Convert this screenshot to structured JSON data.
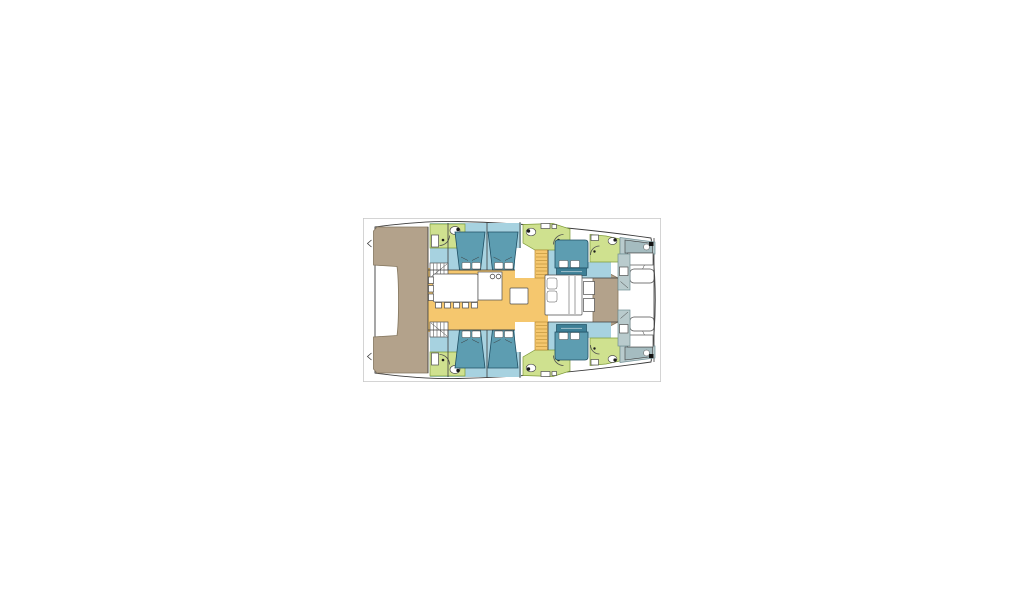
{
  "scene": {
    "type": "yacht-deck-plan",
    "vessel": "sailing-catamaran",
    "view": "top-down-interior-layout",
    "orientation": "bow-right-stern-left"
  },
  "colors": {
    "page-bg": "#ffffff",
    "plan-border": "#c9c9c9",
    "hull-fill": "#ffffff",
    "outline": "#3c3c3c",
    "deck": "#b3a28b",
    "deck-edge": "#84765e",
    "cabin": "#a7d2e0",
    "bed": "#5d9db1",
    "bed-front": "#3d7f96",
    "bed-edge": "#1f4f63",
    "bath": "#cfe18f",
    "bath-edge": "#7f9c3a",
    "galley": "#f5c76e",
    "galley-edge": "#b98c33",
    "crew": "#b9cbcd",
    "crew-bed": "#a5bcc0",
    "crew-dark": "#6f8d93",
    "white": "#ffffff",
    "fixture-edge": "#4f4f4f"
  },
  "rooms": [
    {
      "name": "aft-cockpit-deck",
      "fill": "#b3a28b"
    },
    {
      "name": "transom-notch",
      "fill": "#ffffff"
    },
    {
      "name": "salon-galley",
      "fill": "#f5c76e"
    },
    {
      "name": "dining-table-with-chairs",
      "fill": "#ffffff"
    },
    {
      "name": "galley-island",
      "fill": "#ffffff"
    },
    {
      "name": "starboard-aft-guest-cabins",
      "fill": "#a7d2e0"
    },
    {
      "name": "port-aft-guest-cabins",
      "fill": "#a7d2e0"
    },
    {
      "name": "forward-guest-cabins",
      "fill": "#a7d2e0"
    },
    {
      "name": "bathrooms-with-shower-and-toilet",
      "fill": "#cfe18f"
    },
    {
      "name": "companionway-stairs",
      "fill": "#f5c76e"
    },
    {
      "name": "central-forward-berth",
      "fill": "#ffffff"
    },
    {
      "name": "foredeck",
      "fill": "#b3a28b"
    },
    {
      "name": "bow-crew-berths",
      "fill": "#b9cbcd"
    },
    {
      "name": "trampoline-bow-area",
      "fill": "#ffffff"
    }
  ]
}
